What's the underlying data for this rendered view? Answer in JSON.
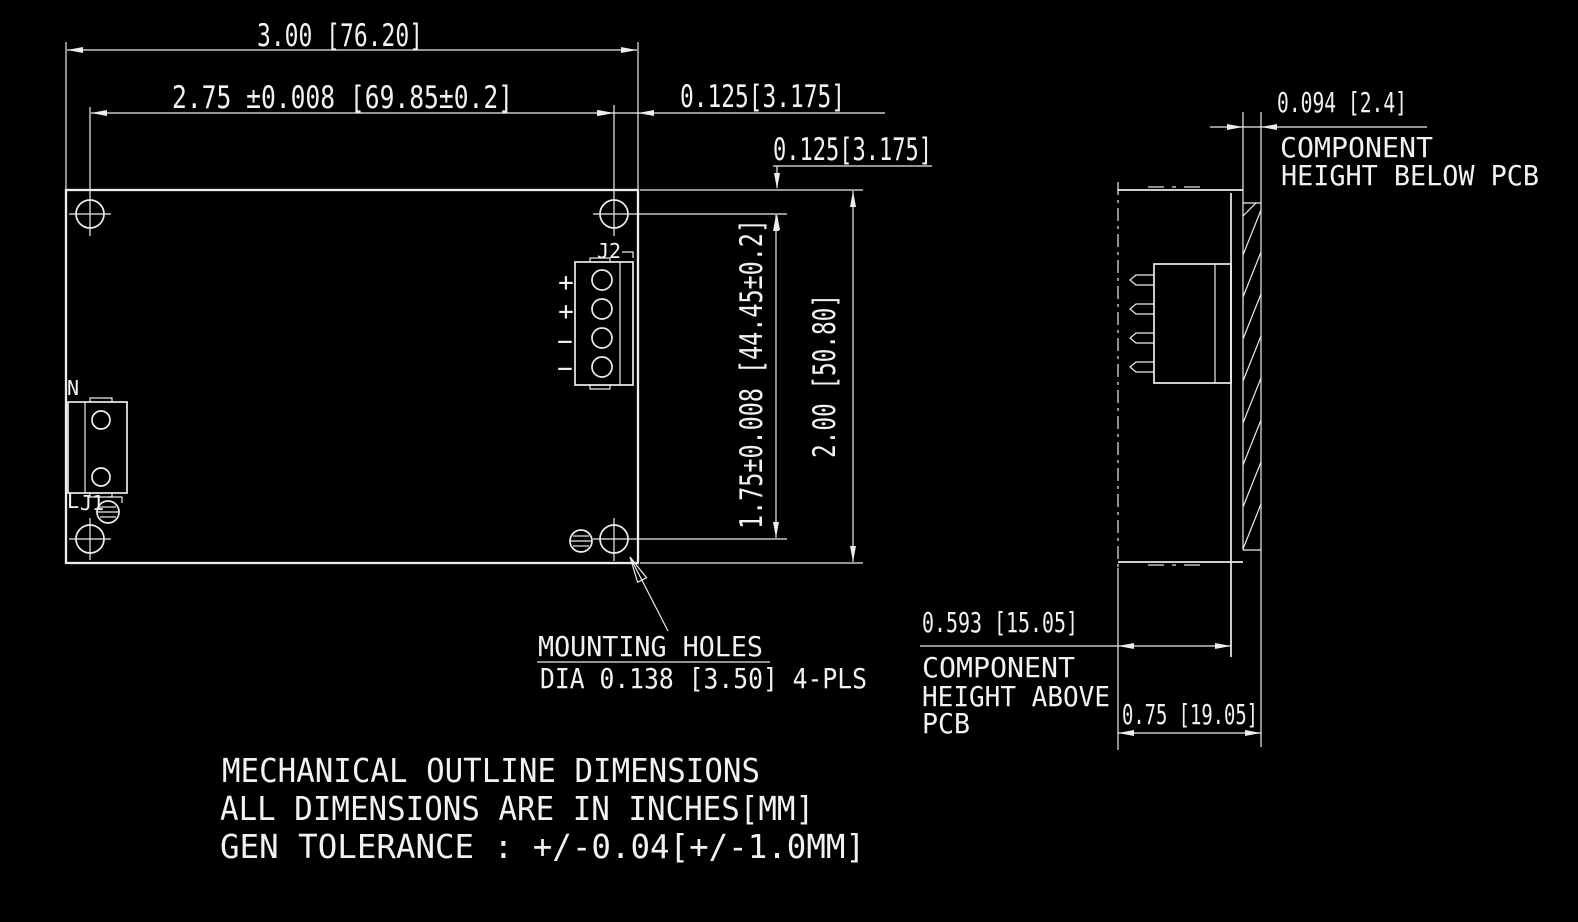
{
  "drawing": {
    "type": "mechanical-outline",
    "colors": {
      "background": "#000000",
      "line": "#ededed",
      "text": "#f2f2f2"
    }
  },
  "top_view": {
    "dim_width": "3.00 [76.20]",
    "dim_hole_span_h": "2.75 ±0.008 [69.85±0.2]",
    "dim_offset_right": "0.125[3.175]",
    "dim_offset_top": "0.125[3.175]",
    "dim_hole_span_v": "1.75±0.008 [44.45±0.2]",
    "dim_height": "2.00 [50.80]",
    "label_n": "N",
    "label_l": "L",
    "label_j1": "J1",
    "label_j2": "J2",
    "j2_terminals": [
      "+",
      "+",
      "−",
      "−"
    ],
    "mounting_note_1": "MOUNTING HOLES",
    "mounting_note_2": "DIA 0.138 [3.50] 4-PLS"
  },
  "side_view": {
    "dim_below_pcb": "0.094 [2.4]",
    "below_label_1": "COMPONENT",
    "below_label_2": "HEIGHT BELOW PCB",
    "dim_above_pcb": "0.593 [15.05]",
    "above_label_1": "COMPONENT",
    "above_label_2": "HEIGHT ABOVE",
    "above_label_3": "PCB",
    "dim_depth": "0.75 [19.05]"
  },
  "notes": [
    "MECHANICAL OUTLINE DIMENSIONS",
    "ALL DIMENSIONS ARE IN INCHES[MM]",
    "GEN TOLERANCE : +/-0.04[+/-1.0MM]"
  ]
}
